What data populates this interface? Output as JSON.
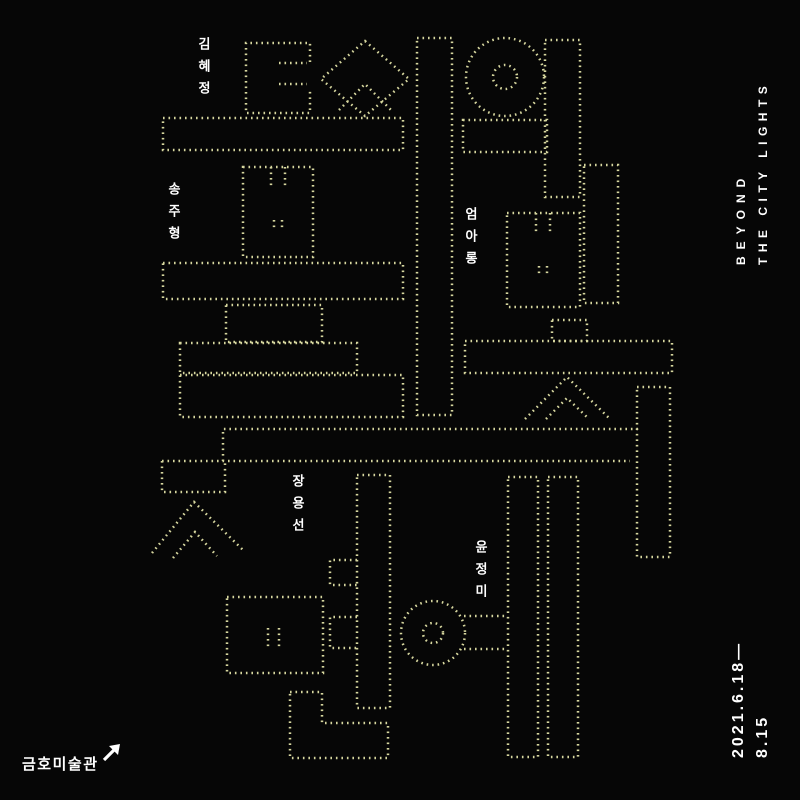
{
  "poster": {
    "title_korean": "도시의 불빛 저편에",
    "title_chars": [
      "도",
      "시",
      "의",
      "불",
      "빛",
      "저",
      "편",
      "에"
    ],
    "title_english": {
      "line1": "BEYOND",
      "line2": "THE CITY LIGHTS"
    },
    "dates": {
      "line1": "2021.6.18—",
      "line2": "8.15"
    },
    "venue": "금호미술관",
    "arrow_icon": "↗",
    "artists": [
      "김혜정",
      "송주형",
      "엄아롱",
      "장용선",
      "윤정미"
    ],
    "colors": {
      "background": "#060606",
      "dots": "#d6d69e",
      "text": "#ffffff"
    }
  }
}
